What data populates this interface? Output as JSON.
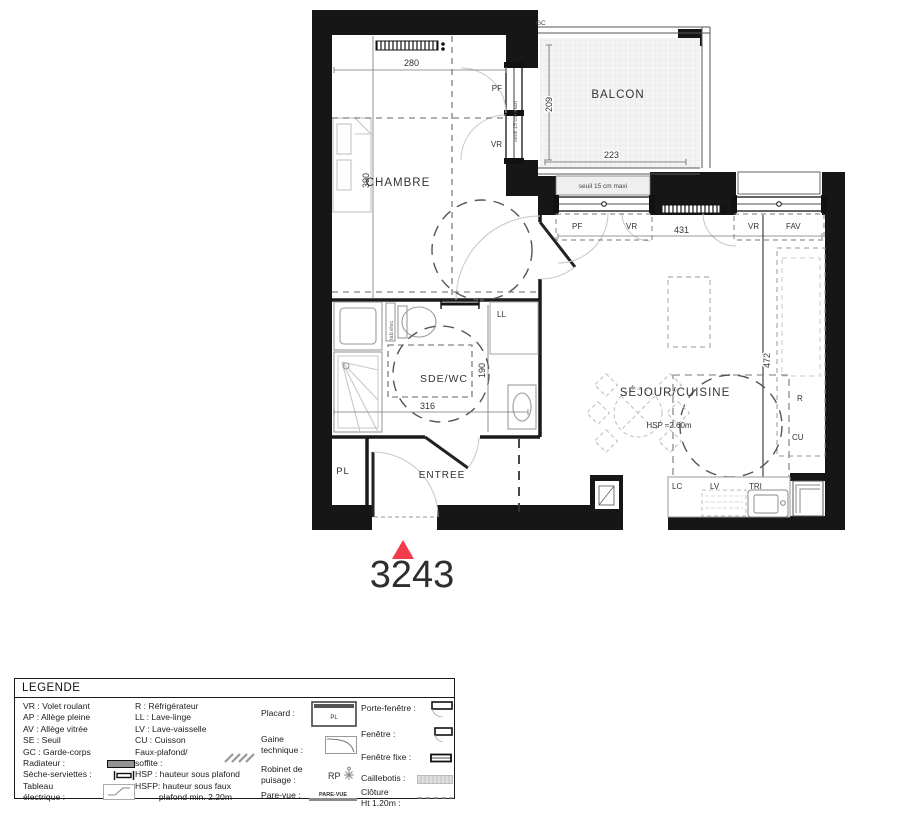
{
  "colors": {
    "accent": "#f43b4b"
  },
  "unit": {
    "number": "3243"
  },
  "plan": {
    "rooms": {
      "chambre": "CHAMBRE",
      "balcon": "BALCON",
      "sde": "SDE/WC",
      "sejour": "SÉJOUR/CUISINE",
      "entree": "ENTREE",
      "pl": "PL"
    },
    "labels": {
      "gc": "GC",
      "pf": "PF",
      "vr": "VR",
      "fav": "FAV",
      "ll": "LL",
      "lc": "LC",
      "lv": "LV",
      "tri": "TRI",
      "r": "R",
      "cu": "CU",
      "hsp": "HSP ≈2.60m",
      "seuil": "seuil 15 cm maxi",
      "tab_elec": "tab.élec"
    },
    "dims": {
      "w280": "280",
      "h390": "390",
      "h209": "209",
      "w223": "223",
      "w431": "431",
      "h472": "472",
      "w316": "316",
      "h190": "190"
    }
  },
  "legend": {
    "title": "LEGENDE",
    "col1": [
      {
        "label": "VR : Volet roulant"
      },
      {
        "label": "AP : Allège pleine"
      },
      {
        "label": "AV : Allège vitrée"
      },
      {
        "label": "SE : Seuil"
      },
      {
        "label": "GC : Garde-corps"
      },
      {
        "label": "Radiateur :"
      },
      {
        "label": "Sèche-serviettes :"
      },
      {
        "label": "Tableau\nélectrique :"
      }
    ],
    "col2": [
      {
        "label": "R : Réfrigérateur"
      },
      {
        "label": "LL : Lave-linge"
      },
      {
        "label": "LV : Lave-vaisselle"
      },
      {
        "label": "CU : Cuisson"
      },
      {
        "label": "Faux-plafond/\nsoffite :"
      },
      {
        "label": "HSP : hauteur sous plafond"
      },
      {
        "label": "HSFP: hauteur sous faux\n          plafond min. 2.20m"
      }
    ],
    "col3": [
      {
        "label": "Placard :"
      },
      {
        "label": "Gaine\ntechnique :"
      },
      {
        "label": "Robinet de\npuisage :"
      },
      {
        "label": "Pare-vue :"
      }
    ],
    "col4": [
      {
        "label": "Porte-fenêtre :"
      },
      {
        "label": "Fenêtre :"
      },
      {
        "label": "Fenêtre fixe :"
      },
      {
        "label": "Caillebotis :"
      },
      {
        "label": "Clôture\nHt 1.20m :"
      }
    ],
    "symbols": {
      "placard_text": "PL",
      "rp_text": "RP",
      "parevue_text": "PARE-VUE"
    }
  }
}
